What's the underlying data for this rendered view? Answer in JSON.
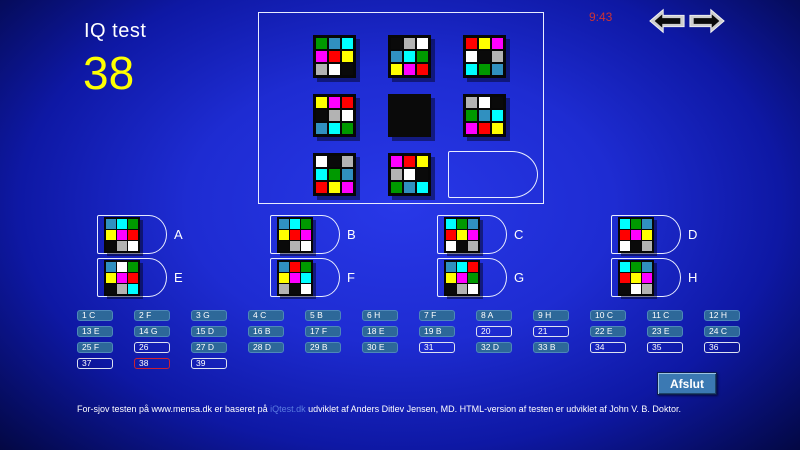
{
  "header": {
    "title": "IQ test",
    "question_number": "38",
    "timer": "9:43"
  },
  "palette": {
    "K": "#0a0a0a",
    "W": "#ffffff",
    "A": "#b3b3b3",
    "R": "#ff0000",
    "Y": "#ffff00",
    "M": "#ff00ff",
    "C": "#00ffff",
    "G": "#009900",
    "B": "#3090c0"
  },
  "puzzle": {
    "grid": [
      {
        "type": "matrix",
        "rows": [
          [
            "G",
            "B",
            "C"
          ],
          [
            "M",
            "R",
            "Y"
          ],
          [
            "A",
            "W",
            "K"
          ]
        ]
      },
      {
        "type": "matrix",
        "rows": [
          [
            "K",
            "A",
            "W"
          ],
          [
            "B",
            "C",
            "G"
          ],
          [
            "Y",
            "M",
            "R"
          ]
        ]
      },
      {
        "type": "matrix",
        "rows": [
          [
            "R",
            "Y",
            "M"
          ],
          [
            "W",
            "K",
            "A"
          ],
          [
            "C",
            "G",
            "B"
          ]
        ]
      },
      {
        "type": "matrix",
        "rows": [
          [
            "Y",
            "M",
            "R"
          ],
          [
            "K",
            "A",
            "W"
          ],
          [
            "B",
            "C",
            "G"
          ]
        ]
      },
      {
        "type": "black"
      },
      {
        "type": "matrix",
        "rows": [
          [
            "A",
            "W",
            "K"
          ],
          [
            "G",
            "B",
            "C"
          ],
          [
            "M",
            "R",
            "Y"
          ]
        ]
      },
      {
        "type": "matrix",
        "rows": [
          [
            "W",
            "K",
            "A"
          ],
          [
            "C",
            "G",
            "B"
          ],
          [
            "R",
            "Y",
            "M"
          ]
        ]
      },
      {
        "type": "matrix",
        "rows": [
          [
            "M",
            "R",
            "Y"
          ],
          [
            "A",
            "W",
            "K"
          ],
          [
            "G",
            "B",
            "C"
          ]
        ]
      },
      {
        "type": "slot"
      }
    ]
  },
  "options": [
    {
      "letter": "A",
      "rows": [
        [
          "B",
          "C",
          "G"
        ],
        [
          "Y",
          "M",
          "R"
        ],
        [
          "K",
          "A",
          "W"
        ]
      ]
    },
    {
      "letter": "B",
      "rows": [
        [
          "B",
          "C",
          "G"
        ],
        [
          "Y",
          "R",
          "M"
        ],
        [
          "K",
          "A",
          "W"
        ]
      ]
    },
    {
      "letter": "C",
      "rows": [
        [
          "C",
          "G",
          "B"
        ],
        [
          "R",
          "Y",
          "M"
        ],
        [
          "W",
          "K",
          "A"
        ]
      ]
    },
    {
      "letter": "D",
      "rows": [
        [
          "C",
          "G",
          "B"
        ],
        [
          "R",
          "M",
          "Y"
        ],
        [
          "W",
          "K",
          "A"
        ]
      ]
    },
    {
      "letter": "E",
      "rows": [
        [
          "B",
          "W",
          "G"
        ],
        [
          "Y",
          "M",
          "R"
        ],
        [
          "K",
          "A",
          "C"
        ]
      ]
    },
    {
      "letter": "F",
      "rows": [
        [
          "B",
          "R",
          "G"
        ],
        [
          "Y",
          "M",
          "C"
        ],
        [
          "A",
          "K",
          "W"
        ]
      ]
    },
    {
      "letter": "G",
      "rows": [
        [
          "B",
          "C",
          "R"
        ],
        [
          "Y",
          "M",
          "G"
        ],
        [
          "K",
          "A",
          "W"
        ]
      ]
    },
    {
      "letter": "H",
      "rows": [
        [
          "C",
          "G",
          "B"
        ],
        [
          "R",
          "Y",
          "M"
        ],
        [
          "K",
          "W",
          "A"
        ]
      ]
    }
  ],
  "answer_sheet": {
    "cells": [
      {
        "n": "1",
        "a": "C"
      },
      {
        "n": "2",
        "a": "F"
      },
      {
        "n": "3",
        "a": "G"
      },
      {
        "n": "4",
        "a": "C"
      },
      {
        "n": "5",
        "a": "B"
      },
      {
        "n": "6",
        "a": "H"
      },
      {
        "n": "7",
        "a": "F"
      },
      {
        "n": "8",
        "a": "A"
      },
      {
        "n": "9",
        "a": "H"
      },
      {
        "n": "10",
        "a": "C"
      },
      {
        "n": "11",
        "a": "C"
      },
      {
        "n": "12",
        "a": "H"
      },
      {
        "n": "13",
        "a": "E"
      },
      {
        "n": "14",
        "a": "G"
      },
      {
        "n": "15",
        "a": "D"
      },
      {
        "n": "16",
        "a": "B"
      },
      {
        "n": "17",
        "a": "F"
      },
      {
        "n": "18",
        "a": "E"
      },
      {
        "n": "19",
        "a": "B"
      },
      {
        "n": "20",
        "a": ""
      },
      {
        "n": "21",
        "a": ""
      },
      {
        "n": "22",
        "a": "E"
      },
      {
        "n": "23",
        "a": "E"
      },
      {
        "n": "24",
        "a": "C"
      },
      {
        "n": "25",
        "a": "F"
      },
      {
        "n": "26",
        "a": ""
      },
      {
        "n": "27",
        "a": "D"
      },
      {
        "n": "28",
        "a": "D"
      },
      {
        "n": "29",
        "a": "B"
      },
      {
        "n": "30",
        "a": "E"
      },
      {
        "n": "31",
        "a": ""
      },
      {
        "n": "32",
        "a": "D"
      },
      {
        "n": "33",
        "a": "B"
      },
      {
        "n": "34",
        "a": ""
      },
      {
        "n": "35",
        "a": ""
      },
      {
        "n": "36",
        "a": ""
      },
      {
        "n": "37",
        "a": ""
      },
      {
        "n": "38",
        "a": "",
        "current": true
      },
      {
        "n": "39",
        "a": ""
      }
    ]
  },
  "footer": {
    "button_label": "Afslut",
    "text_before": "For-sjov testen på www.mensa.dk er baseret på ",
    "link": "iQtest.dk",
    "text_after": " udviklet af Anders Ditlev Jensen, MD. HTML-version af testen er udviklet af John V. B. Doktor."
  },
  "colors": {
    "timer": "#cc3333",
    "question_number": "#ffff00",
    "link": "#5b7ce0",
    "answered_box_bg": "#2d6899",
    "current_box_border": "#cc2233"
  }
}
